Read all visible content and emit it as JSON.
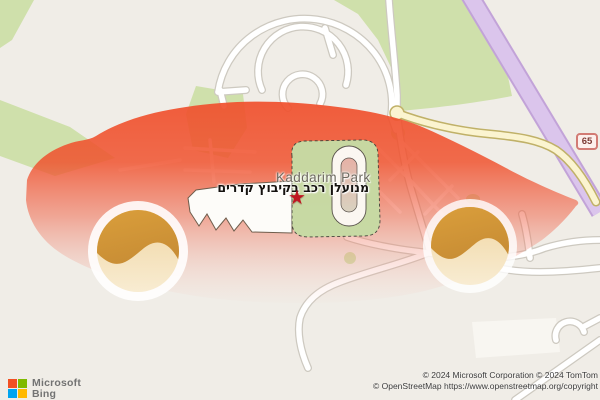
{
  "map": {
    "park_label": "Kaddarim Park",
    "poi_label_hebrew": "מנועלן רכב בקיבוץ קדרים",
    "route_shield": "65",
    "marker_glyph": "★",
    "colors": {
      "land": "#f0ede7",
      "forest_green": "#cfe0ab",
      "park_green": "#c6dba4",
      "road_fill": "#ffffff",
      "road_casing": "#cdc9c0",
      "secondary_road_fill": "#fbf4d0",
      "secondary_road_casing": "#c0b168",
      "motorway_fill": "#dbc5ec",
      "motorway_casing": "#c2a3d8",
      "car_overlay_red": "#f0502d",
      "wheel_orange_dark": "#d3912f",
      "wheel_orange_light": "#f5e2ba",
      "star_red": "#bf1722",
      "shield_border": "#d27b74",
      "shield_text": "#7d3a34"
    }
  },
  "branding": {
    "line1": "Microsoft",
    "line2": "Bing"
  },
  "attribution": {
    "line1": "© 2024 Microsoft Corporation © 2024 TomTom",
    "line2": "© OpenStreetMap https://www.openstreetmap.org/copyright"
  }
}
